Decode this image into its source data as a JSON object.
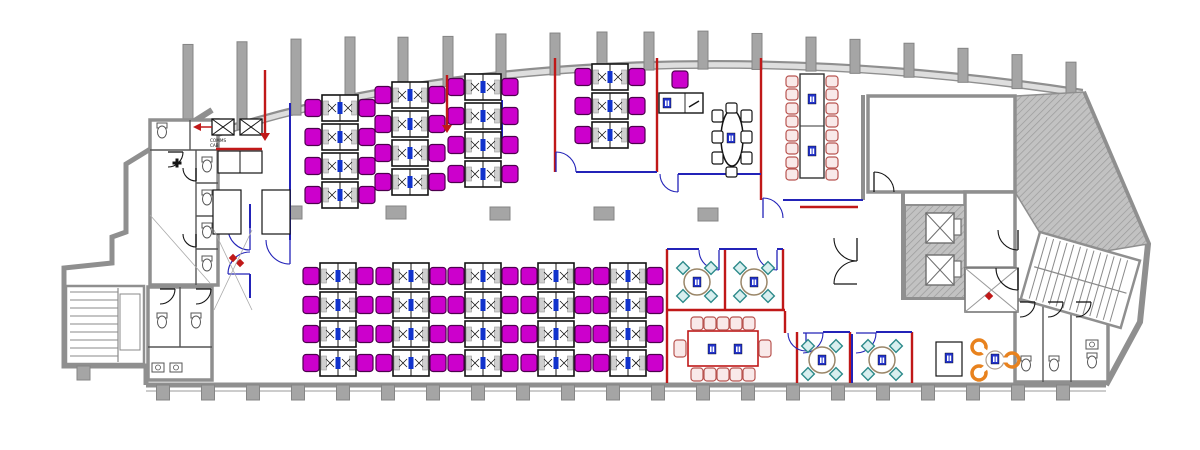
{
  "canvas": {
    "w": 1200,
    "h": 450,
    "bg": "#ffffff"
  },
  "palette": {
    "wall": "#8f8f8f",
    "wall_fill": "#c8c8c8",
    "band_fill": "#dedede",
    "column": "#a5a5a5",
    "column_edge": "#858585",
    "ink": "#141414",
    "red": "#c01818",
    "red_chair": "#b85450",
    "red_chair_fill": "#f9e9e9",
    "blue": "#2323b8",
    "tag": "#2233cc",
    "magenta": "#cc00cc",
    "magenta_edge": "#4d004d",
    "monitor": "#1133cc",
    "teal": "#2e8b8b",
    "teal_fill": "#d8efef",
    "table_edge": "#9a8668",
    "orange": "#e8821e",
    "fixture": "#555555",
    "thin": "#aaaaaa",
    "hatch_line": "#9a9a9a",
    "hatch_bg": "#c2c2c2"
  },
  "labels": {
    "comms_line1": "COMMS",
    "comms_line2": "CAB"
  },
  "facade": {
    "p0": [
      160,
      150
    ],
    "p1": [
      400,
      55
    ],
    "p2": [
      750,
      38
    ],
    "p3": [
      1083,
      90
    ],
    "band": 7
  },
  "top_columns": {
    "x": [
      188,
      242,
      296,
      350,
      403,
      448,
      501,
      555,
      602,
      649,
      703,
      757,
      811,
      855,
      909,
      963,
      1017,
      1071
    ],
    "h": [
      95,
      80,
      68,
      58,
      48,
      42,
      38,
      34,
      32,
      30,
      30,
      28,
      26,
      26,
      26,
      26,
      26,
      26
    ],
    "w": 10
  },
  "bottom_wall": {
    "y": 385,
    "x1": 146,
    "x2": 1106,
    "col_w": 13,
    "col_h": 15,
    "columns": [
      163,
      208,
      253,
      298,
      343,
      388,
      433,
      478,
      523,
      568,
      613,
      658,
      703,
      748,
      793,
      838,
      883,
      928,
      973,
      1018,
      1063
    ]
  },
  "mid_columns": [
    [
      292,
      206
    ],
    [
      396,
      206
    ],
    [
      500,
      207
    ],
    [
      604,
      207
    ],
    [
      708,
      208
    ]
  ],
  "outline": {
    "left": "M212,110 L152,148 L126,164 L126,232 L112,237 L112,263 L64,268 L64,366 L146,366 L146,385",
    "right": "M1083,92 L1148,244 L1140,322 L1106,385"
  },
  "hatch_masses": [
    [
      [
        1015,
        96
      ],
      [
        1083,
        92
      ],
      [
        1148,
        244
      ],
      [
        1100,
        252
      ],
      [
        1040,
        233
      ],
      [
        1015,
        192
      ]
    ]
  ],
  "desk_geom": {
    "w": 36,
    "h": 26,
    "row_h": 29,
    "chair_w": 16,
    "chair_h": 17
  },
  "desk_banks": [
    {
      "x": 322,
      "y": 95,
      "rows": 4
    },
    {
      "x": 392,
      "y": 82,
      "rows": 4
    },
    {
      "x": 465,
      "y": 74,
      "rows": 4
    },
    {
      "x": 592,
      "y": 64,
      "rows": 3
    },
    {
      "x": 320,
      "y": 263,
      "rows": 4
    },
    {
      "x": 393,
      "y": 263,
      "rows": 4
    },
    {
      "x": 465,
      "y": 263,
      "rows": 4
    },
    {
      "x": 538,
      "y": 263,
      "rows": 4
    },
    {
      "x": 610,
      "y": 263,
      "rows": 4
    }
  ],
  "office_desk": {
    "x": 659,
    "y": 93,
    "w": 44,
    "h": 20,
    "chair": [
      672,
      71
    ],
    "tag": [
      663,
      98
    ]
  },
  "walls_red": [
    [
      555,
      58,
      555,
      172
    ],
    [
      657,
      58,
      657,
      172
    ],
    [
      761,
      58,
      761,
      200
    ],
    [
      800,
      207,
      858,
      207
    ],
    [
      667,
      249,
      667,
      383
    ],
    [
      725,
      249,
      725,
      311
    ],
    [
      783,
      249,
      783,
      311
    ],
    [
      667,
      310,
      785,
      310
    ],
    [
      785,
      311,
      785,
      333
    ],
    [
      797,
      332,
      797,
      383
    ],
    [
      850,
      332,
      850,
      383
    ],
    [
      912,
      332,
      912,
      383
    ],
    [
      216,
      149,
      262,
      149
    ]
  ],
  "walls_blue": [
    [
      290,
      103,
      290,
      240
    ],
    [
      502,
      100,
      502,
      150
    ],
    [
      576,
      172,
      657,
      172
    ],
    [
      678,
      174,
      761,
      174
    ],
    [
      783,
      200,
      863,
      200
    ],
    [
      667,
      249,
      699,
      249
    ],
    [
      719,
      249,
      757,
      249
    ],
    [
      777,
      249,
      783,
      249
    ],
    [
      823,
      332,
      850,
      332
    ],
    [
      876,
      332,
      912,
      332
    ],
    [
      852,
      334,
      852,
      383
    ],
    [
      250,
      204,
      250,
      228
    ],
    [
      250,
      274,
      250,
      298
    ]
  ],
  "walls_gray": [
    [
      863,
      95,
      863,
      200
    ],
    [
      903,
      192,
      903,
      300
    ],
    [
      903,
      298,
      965,
      298
    ]
  ],
  "rooms_gray": [
    {
      "x": 868,
      "y": 96,
      "w": 147,
      "h": 96
    },
    {
      "x": 965,
      "y": 192,
      "w": 50,
      "h": 76
    },
    {
      "x": 150,
      "y": 120,
      "w": 68,
      "h": 165
    },
    {
      "x": 148,
      "y": 287,
      "w": 64,
      "h": 93
    },
    {
      "x": 1015,
      "y": 300,
      "w": 93,
      "h": 82
    }
  ],
  "wc_right_dividers": [
    [
      1043,
      300,
      1043,
      382
    ],
    [
      1071,
      300,
      1071,
      382
    ]
  ],
  "wc_left_upper": {
    "v": [
      196,
      150,
      196,
      285
    ],
    "acc_v": [
      190,
      120,
      190,
      150
    ],
    "h": [
      [
        150,
        150,
        218,
        150
      ],
      [
        196,
        183,
        218,
        183
      ],
      [
        196,
        216,
        218,
        216
      ],
      [
        196,
        249,
        218,
        249
      ]
    ]
  },
  "wc_left_lower": {
    "v": [
      180,
      287,
      180,
      347
    ],
    "h": [
      148,
      347,
      212,
      347
    ]
  },
  "core": {
    "x": 905,
    "y": 205,
    "w": 60,
    "h": 93,
    "shafts": [
      [
        926,
        213
      ],
      [
        926,
        255
      ]
    ],
    "shaft_w": 28,
    "shaft_h": 30,
    "slots": [
      [
        954,
        219
      ],
      [
        954,
        261
      ]
    ],
    "slot_w": 7,
    "slot_h": 16
  },
  "winder": {
    "x": 965,
    "y": 268,
    "w": 53,
    "h": 44
  },
  "stairs_left": {
    "x": 66,
    "y": 286,
    "w": 78,
    "h": 78,
    "treads_y1": 292,
    "treads_y2": 358,
    "step": 8,
    "tx1": 70,
    "tx2": 118,
    "div_x": 118,
    "inner": [
      120,
      294,
      20,
      56
    ]
  },
  "stairs_right": {
    "x": 1040,
    "y": 232,
    "w": 104,
    "h": 70,
    "rot": 16,
    "step": 7
  },
  "doors": [
    {
      "h": [
        556,
        172
      ],
      "r": 20,
      "a1": 270,
      "a2": 360,
      "c": "blue"
    },
    {
      "h": [
        678,
        174
      ],
      "r": 18,
      "a1": 90,
      "a2": 180,
      "c": "blue"
    },
    {
      "h": [
        763,
        218
      ],
      "r": 20,
      "a1": 270,
      "a2": 360,
      "c": "blue"
    },
    {
      "h": [
        250,
        228
      ],
      "r": 22,
      "a1": 90,
      "a2": 180,
      "c": "blue"
    },
    {
      "h": [
        250,
        274
      ],
      "r": 22,
      "a1": 180,
      "a2": 270,
      "c": "blue"
    },
    {
      "h": [
        290,
        240
      ],
      "r": 24,
      "a1": 90,
      "a2": 180,
      "c": "blue"
    },
    {
      "h": [
        719,
        250
      ],
      "r": 20,
      "a1": 90,
      "a2": 180,
      "c": "blue"
    },
    {
      "h": [
        777,
        250
      ],
      "r": 20,
      "a1": 90,
      "a2": 180,
      "c": "blue"
    },
    {
      "h": [
        806,
        333
      ],
      "r": 18,
      "a1": 90,
      "a2": 180,
      "c": "blue"
    },
    {
      "h": [
        803,
        333
      ],
      "r": 20,
      "a1": 0,
      "a2": 90,
      "c": "blue"
    },
    {
      "h": [
        856,
        333
      ],
      "r": 20,
      "a1": 0,
      "a2": 90,
      "c": "blue"
    },
    {
      "h": [
        874,
        192
      ],
      "r": 20,
      "a1": 270,
      "a2": 360,
      "c": "ink"
    },
    {
      "h": [
        857,
        238
      ],
      "r": 23,
      "a1": 90,
      "a2": 180,
      "c": "ink"
    },
    {
      "h": [
        857,
        284
      ],
      "r": 23,
      "a1": 180,
      "a2": 270,
      "c": "ink"
    },
    {
      "h": [
        1018,
        230
      ],
      "r": 20,
      "a1": 90,
      "a2": 180,
      "c": "ink"
    },
    {
      "h": [
        1018,
        268
      ],
      "r": 22,
      "a1": 90,
      "a2": 180,
      "c": "ink"
    },
    {
      "h": [
        1020,
        302
      ],
      "r": 15,
      "a1": 0,
      "a2": 90,
      "c": "ink"
    },
    {
      "h": [
        1048,
        302
      ],
      "r": 15,
      "a1": 0,
      "a2": 90,
      "c": "ink"
    },
    {
      "h": [
        1076,
        302
      ],
      "r": 15,
      "a1": 0,
      "a2": 90,
      "c": "ink"
    },
    {
      "h": [
        160,
        289
      ],
      "r": 15,
      "a1": 0,
      "a2": 90,
      "c": "ink"
    },
    {
      "h": [
        196,
        289
      ],
      "r": 15,
      "a1": 0,
      "a2": 90,
      "c": "ink"
    },
    {
      "h": [
        168,
        152
      ],
      "r": 15,
      "a1": 0,
      "a2": 90,
      "c": "ink"
    },
    {
      "h": [
        196,
        168
      ],
      "r": 13,
      "a1": 90,
      "a2": 180,
      "c": "ink"
    },
    {
      "h": [
        196,
        234
      ],
      "r": 13,
      "a1": 90,
      "a2": 180,
      "c": "ink"
    }
  ],
  "oval_meeting": {
    "cx": 732,
    "cy": 138,
    "rx": 11,
    "ry": 28,
    "tag": [
      727,
      133
    ],
    "chairs_left_x": 712,
    "chairs_right_x": 741,
    "chairs_y": [
      110,
      131,
      152
    ],
    "cap_top": [
      726,
      103
    ],
    "cap_bottom": [
      726,
      167
    ],
    "chair_w": 11,
    "chair_h": 12
  },
  "boardroom_top": {
    "table": [
      800,
      74,
      24,
      104
    ],
    "split_y": 126,
    "tags": [
      [
        808,
        94
      ],
      [
        808,
        146
      ]
    ],
    "chair_left_x": 786,
    "chair_right_x": 826,
    "chair_ys": [
      76,
      89,
      103,
      116,
      130,
      143,
      157,
      169
    ],
    "chair_w": 12,
    "chair_h": 11
  },
  "boardroom_bottom": {
    "table": [
      688,
      331,
      70,
      35
    ],
    "tags": [
      [
        708,
        344
      ],
      [
        734,
        344
      ]
    ],
    "top_y": 317,
    "bot_y": 368,
    "xs": [
      691,
      704,
      717,
      730,
      743
    ],
    "chair_w": 12,
    "chair_h": 13,
    "ends": [
      [
        674,
        340
      ],
      [
        759,
        340
      ]
    ],
    "end_w": 12,
    "end_h": 17
  },
  "round_rooms": [
    {
      "cx": 697,
      "cy": 282
    },
    {
      "cx": 754,
      "cy": 282
    },
    {
      "cx": 822,
      "cy": 360
    },
    {
      "cx": 882,
      "cy": 360
    }
  ],
  "round_geom": {
    "r": 13,
    "chair_off": 14,
    "chair_size": 9
  },
  "orange_area": {
    "cx": 995,
    "cy": 360,
    "r": 9,
    "tag": [
      991,
      354
    ],
    "chairs": [
      [
        979,
        347
      ],
      [
        979,
        373
      ],
      [
        1012,
        360
      ]
    ],
    "chair_r": 7
  },
  "side_table": {
    "x": 936,
    "y": 342,
    "w": 26,
    "h": 34,
    "tag": [
      945,
      353
    ]
  },
  "comms_boxes": [
    [
      212,
      119
    ],
    [
      240,
      119
    ]
  ],
  "comms_box_size": [
    22,
    16
  ],
  "cupboards": {
    "x": 218,
    "y": 151,
    "w": 44,
    "h": 22,
    "split": 240
  },
  "white_boxes": [
    [
      213,
      190,
      28,
      44
    ],
    [
      262,
      190,
      28,
      44
    ]
  ],
  "risers": [
    {
      "x": 265,
      "y1": 70,
      "y2": 133
    },
    {
      "x": 447,
      "y1": 75,
      "y2": 125
    }
  ],
  "red_arrow": {
    "x": 200,
    "y": 127
  },
  "red_marks": [
    [
      233,
      258
    ],
    [
      240,
      263
    ],
    [
      989,
      296
    ]
  ],
  "thin_lines": [
    [
      214,
      230,
      252,
      310
    ],
    [
      252,
      230,
      214,
      310
    ],
    [
      150,
      215,
      210,
      283
    ]
  ],
  "toilets": [
    [
      162,
      132
    ],
    [
      207,
      166
    ],
    [
      207,
      199
    ],
    [
      207,
      232
    ],
    [
      207,
      265
    ],
    [
      162,
      322
    ],
    [
      196,
      322
    ],
    [
      1026,
      365
    ],
    [
      1054,
      365
    ],
    [
      1092,
      362
    ]
  ],
  "sinks": [
    [
      152,
      363
    ],
    [
      170,
      363
    ],
    [
      1086,
      340
    ]
  ],
  "plus_mark": [
    177,
    163
  ]
}
